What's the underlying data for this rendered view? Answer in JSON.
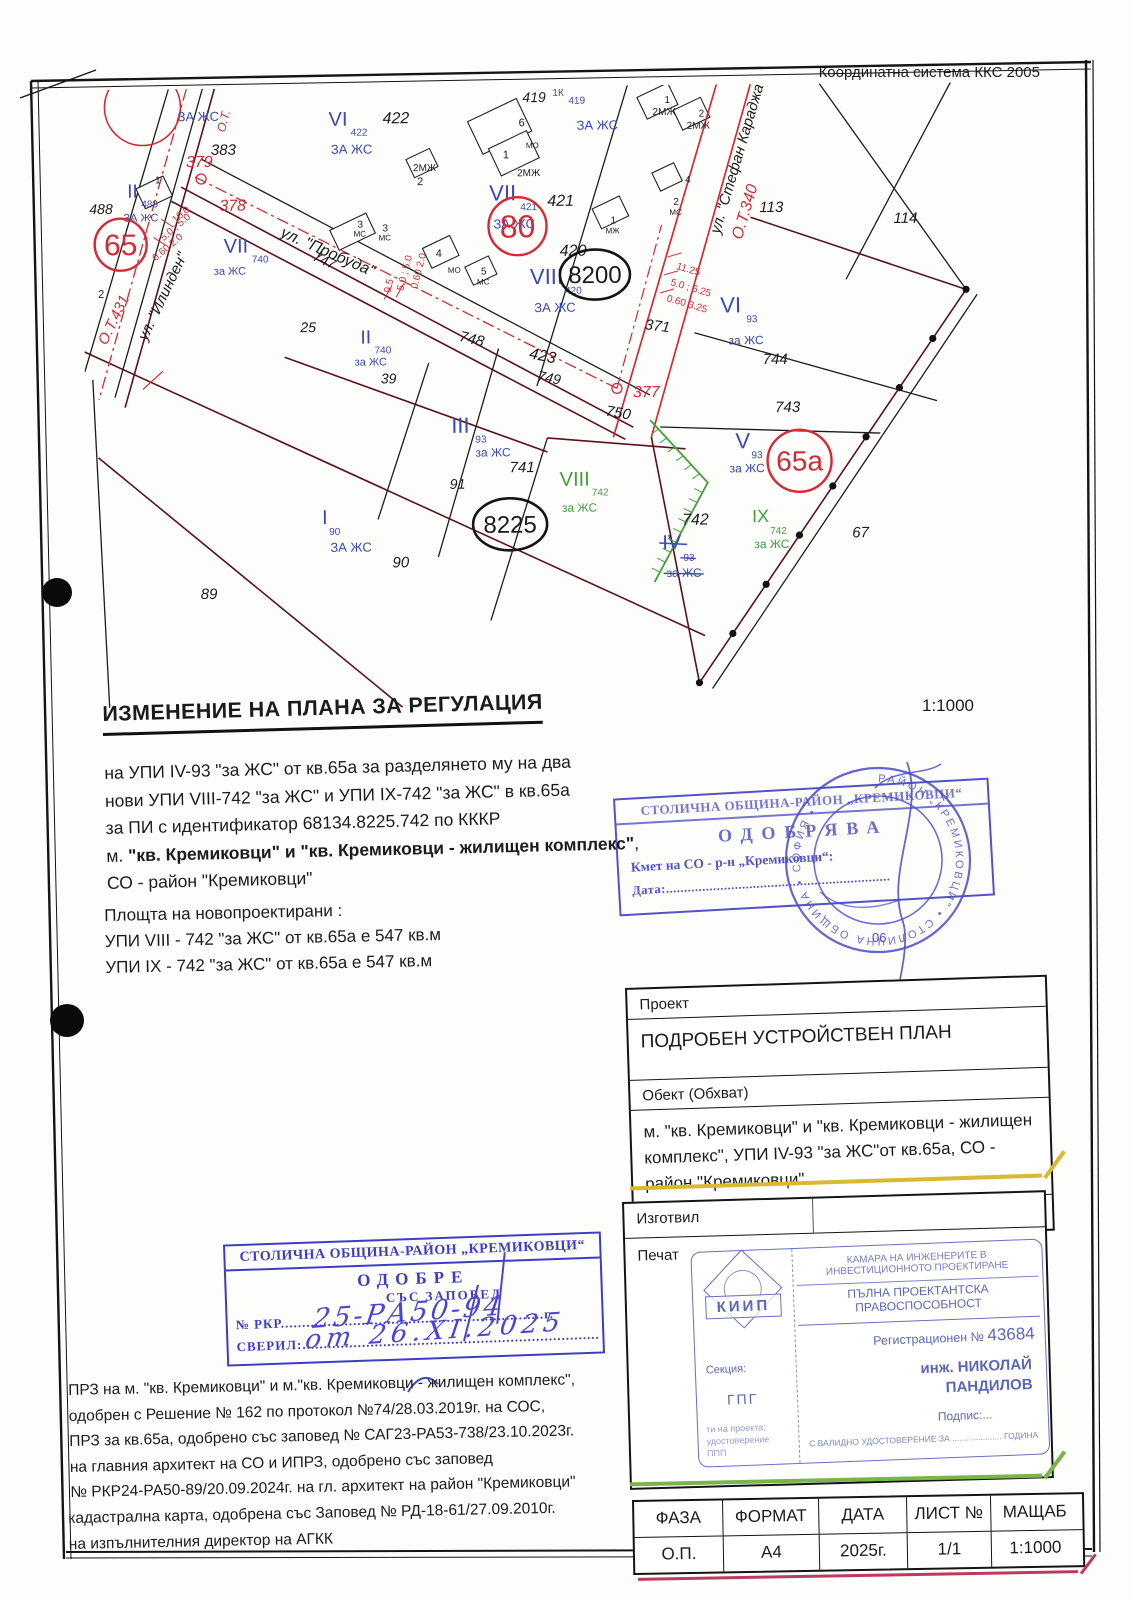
{
  "page": {
    "coord_system": "Координатна система ККС 2005",
    "map_scale": "1:1000",
    "title": "ИЗМЕНЕНИЕ НА ПЛАНА ЗА РЕГУЛАЦИЯ"
  },
  "description": {
    "line1": "на УПИ IV-93 \"за ЖС\" от кв.65а за разделянето му на два",
    "line2": "нови УПИ VIII-742 \"за ЖС\" и УПИ IX-742 \"за ЖС\" в кв.65а",
    "line3": "за ПИ с идентификатор 68134.8225.742 по КККР",
    "line4_prefix": "м. ",
    "line4_bold": "\"кв. Кремиковци\" и \"кв. Кремиковци - жилищен комплекс\"",
    "line4_suffix": ",",
    "line5": "СО - район \"Кремиковци\""
  },
  "areas": {
    "title": "Площта на новопроектирани :",
    "line1": "УПИ VIII - 742 \"за ЖС\" от кв.65а е 547 кв.м",
    "line2": "УПИ IX - 742 \"за ЖС\" от кв.65а е 547 кв.м"
  },
  "stamp_right": {
    "header": "СТОЛИЧНА ОБЩИНА-РАЙОН „КРЕМИКОВЦИ“",
    "action": "ОДОБРЯВА",
    "signer": "Кмет на СО - р-н „Кремиковци“:",
    "date_label": "Дата:..............................................................",
    "seal_ring_text": "РАЙОН „КРЕМИКОВЦИ\" • СТОЛИЧНА ОБЩИНА • СОФИЯ •",
    "seal_number": "06"
  },
  "project_table": {
    "project_label": "Проект",
    "project_value": "ПОДРОБЕН УСТРОЙСТВЕН ПЛАН",
    "object_label": "Обект (Обхват)",
    "object_value": "м. \"кв. Кремиковци\" и \"кв. Кремиковци - жилищен комплекс\", УПИ IV-93 \"за ЖС\"от кв.65а, СО - район \"Кремиковци\"",
    "part_label": "Част",
    "part_value": "ИПР"
  },
  "author_box": {
    "author_label": "Изготвил",
    "stamp_label": "Печат"
  },
  "kiip_stamp": {
    "org": "КАМАРА НА ИНЖЕНЕРИТЕ В ИНВЕСТИЦИОННОТО ПРОЕКТИРАНЕ",
    "qualification": "ПЪЛНА ПРОЕКТАНТСКА ПРАВОСПОСОБНОСТ",
    "reg_label": "Регистрационен № ",
    "reg_number": "43684",
    "name_line1": "инж. НИКОЛАЙ",
    "name_line2": "ПАНДИЛОВ",
    "logo": "КИИП",
    "section_label": "Секция:",
    "section_value": "ГПГ",
    "note1": "ти на проекта:",
    "note2": "удостоверение",
    "note3": "ППП",
    "signature_label": "Подпис:...",
    "footer": "С ВАЛИДНО УДОСТОВЕРЕНИЕ ЗА ..................... ГОДИНА"
  },
  "stamp_left": {
    "header": "СТОЛИЧНА ОБЩИНА-РАЙОН „КРЕМИКОВЦИ“",
    "action_line1": "ОДОБРЕ",
    "action_line2": "СЪС ЗАПОВЕД",
    "number_label": "№ РКР",
    "number_dots": "..............................................................г.",
    "number_value": "25-РА50-94",
    "checked_label": "СВЕРИЛ:",
    "checked_dots": "......................................................................",
    "checked_value": "от 26.ХІ.2025"
  },
  "notes": {
    "p1l1": "ПРЗ на м. \"кв. Кремиковци\" и м.\"кв. Кремиковци - жилищен комплекс\",",
    "p1l2": "одобрен с Решение № 162 по протокол №74/28.03.2019г. на СОС,",
    "p1l3": "ПРЗ за кв.65а, одобрено със заповед № САГ23-РА53-738/23.10.2023г.",
    "p1l4": "на главния архитект на СО и ИПРЗ, одобрено със заповед",
    "p1l5": "№ РКР24-РА50-89/20.09.2024г. на гл. архитект на район \"Кремиковци\"",
    "p2l1": "кадастрална карта, одобрена със Заповед № РД-18-61/27.09.2010г.",
    "p2l2": "на изпълнителния директор на АГКК"
  },
  "spec_table": {
    "headers": [
      "ФАЗА",
      "ФОРМАТ",
      "ДАТА",
      "ЛИСТ №",
      "МАЩАБ"
    ],
    "values": [
      "О.П.",
      "А4",
      "2025г.",
      "1/1",
      "1:1000"
    ]
  },
  "map": {
    "labels": [
      {
        "t": "ЗА ЖС",
        "x": 95,
        "y": 32,
        "c": "b",
        "s": 13
      },
      {
        "t": "О.Т.",
        "x": 142,
        "y": 44,
        "c": "r",
        "s": 12,
        "r": -75,
        "i": 1
      },
      {
        "t": "383",
        "x": 128,
        "y": 66,
        "c": "k",
        "s": 15,
        "i": 1
      },
      {
        "t": "379",
        "x": 103,
        "y": 78,
        "c": "r",
        "s": 16,
        "i": 1
      },
      {
        "t": "378",
        "x": 136,
        "y": 122,
        "c": "r",
        "s": 16,
        "i": 1
      },
      {
        "t": "II",
        "x": 44,
        "y": 108,
        "c": "b",
        "s": 19
      },
      {
        "t": "488",
        "x": 58,
        "y": 118,
        "c": "b",
        "s": 10
      },
      {
        "t": "1",
        "x": 72,
        "y": 94,
        "c": "k",
        "s": 10
      },
      {
        "t": "488",
        "x": 6,
        "y": 124,
        "c": "k",
        "s": 14,
        "i": 1
      },
      {
        "t": "ЗА ЖС",
        "x": 40,
        "y": 132,
        "c": "b",
        "s": 11
      },
      {
        "t": "2",
        "x": 14,
        "y": 208,
        "c": "k",
        "s": 11
      },
      {
        "t": "VII",
        "x": 140,
        "y": 164,
        "c": "b",
        "s": 20
      },
      {
        "t": "740",
        "x": 168,
        "y": 174,
        "c": "b",
        "s": 10
      },
      {
        "t": "за ЖС",
        "x": 130,
        "y": 186,
        "c": "b",
        "s": 11
      },
      {
        "t": "ул. \"Пробуда\"",
        "x": 196,
        "y": 148,
        "c": "k",
        "s": 16,
        "i": 1,
        "r": 24
      },
      {
        "t": "747",
        "x": 228,
        "y": 172,
        "c": "k",
        "s": 14,
        "i": 1,
        "r": 24
      },
      {
        "t": "ул. \"Илинден\"",
        "x": 62,
        "y": 252,
        "c": "k",
        "s": 15,
        "i": 1,
        "r": -64
      },
      {
        "t": "О.Т.431",
        "x": 22,
        "y": 256,
        "c": "r",
        "s": 15,
        "i": 1,
        "r": -64
      },
      {
        "t": "10.0",
        "x": 92,
        "y": 134,
        "c": "r",
        "s": 10,
        "r": -40
      },
      {
        "t": "5.0 ; 5.0",
        "x": 80,
        "y": 152,
        "c": "r",
        "s": 10,
        "r": -40
      },
      {
        "t": "0.60  2.0",
        "x": 72,
        "y": 172,
        "c": "r",
        "s": 10,
        "r": -40
      },
      {
        "t": "25",
        "x": 216,
        "y": 244,
        "c": "k",
        "s": 14,
        "i": 1
      },
      {
        "t": "II",
        "x": 276,
        "y": 256,
        "c": "b",
        "s": 19
      },
      {
        "t": "740",
        "x": 290,
        "y": 266,
        "c": "b",
        "s": 10
      },
      {
        "t": "за ЖС",
        "x": 270,
        "y": 278,
        "c": "b",
        "s": 11
      },
      {
        "t": "39",
        "x": 296,
        "y": 296,
        "c": "k",
        "s": 14,
        "i": 1
      },
      {
        "t": "9.5",
        "x": 306,
        "y": 206,
        "c": "r",
        "s": 10,
        "r": -75
      },
      {
        "t": "5.0 ; 5.0",
        "x": 319,
        "y": 204,
        "c": "r",
        "s": 10,
        "r": -75
      },
      {
        "t": "0.60  2.0",
        "x": 333,
        "y": 202,
        "c": "r",
        "s": 10,
        "r": -75
      },
      {
        "t": "VI",
        "x": 246,
        "y": 38,
        "c": "b",
        "s": 20
      },
      {
        "t": "422",
        "x": 268,
        "y": 48,
        "c": "b",
        "s": 10
      },
      {
        "t": "422",
        "x": 300,
        "y": 36,
        "c": "k",
        "s": 16,
        "i": 1
      },
      {
        "t": "ЗА ЖС",
        "x": 248,
        "y": 66,
        "c": "b",
        "s": 13
      },
      {
        "t": "2МЖ",
        "x": 330,
        "y": 84,
        "c": "k",
        "s": 10
      },
      {
        "t": "2",
        "x": 334,
        "y": 98,
        "c": "k",
        "s": 11
      },
      {
        "t": "3",
        "x": 274,
        "y": 140,
        "c": "k",
        "s": 10
      },
      {
        "t": "МС",
        "x": 270,
        "y": 149,
        "c": "k",
        "s": 8
      },
      {
        "t": "3",
        "x": 299,
        "y": 144,
        "c": "k",
        "s": 10
      },
      {
        "t": "МС",
        "x": 295,
        "y": 153,
        "c": "k",
        "s": 8
      },
      {
        "t": "4",
        "x": 352,
        "y": 170,
        "c": "k",
        "s": 11
      },
      {
        "t": "МО",
        "x": 364,
        "y": 186,
        "c": "k",
        "s": 8
      },
      {
        "t": "5",
        "x": 397,
        "y": 188,
        "c": "k",
        "s": 10
      },
      {
        "t": "МС",
        "x": 393,
        "y": 198,
        "c": "k",
        "s": 8
      },
      {
        "t": "VII",
        "x": 406,
        "y": 114,
        "c": "b",
        "s": 22
      },
      {
        "t": "421",
        "x": 437,
        "y": 124,
        "c": "b",
        "s": 10
      },
      {
        "t": "421",
        "x": 464,
        "y": 120,
        "c": "k",
        "s": 16,
        "i": 1
      },
      {
        "t": "ЗА ЖС",
        "x": 410,
        "y": 142,
        "c": "b",
        "s": 13
      },
      {
        "t": "419",
        "x": 440,
        "y": 16,
        "c": "k",
        "s": 14,
        "i": 1
      },
      {
        "t": "1К",
        "x": 470,
        "y": 10,
        "c": "b",
        "s": 10
      },
      {
        "t": "419",
        "x": 486,
        "y": 18,
        "c": "b",
        "s": 10
      },
      {
        "t": "ЗА ЖС",
        "x": 494,
        "y": 44,
        "c": "b",
        "s": 13
      },
      {
        "t": "6",
        "x": 436,
        "y": 40,
        "c": "k",
        "s": 11
      },
      {
        "t": "МО",
        "x": 443,
        "y": 62,
        "c": "k",
        "s": 8
      },
      {
        "t": "1",
        "x": 420,
        "y": 72,
        "c": "k",
        "s": 11
      },
      {
        "t": "2МЖ",
        "x": 434,
        "y": 90,
        "c": "k",
        "s": 10
      },
      {
        "t": "1",
        "x": 527,
        "y": 138,
        "c": "k",
        "s": 10
      },
      {
        "t": "МЖ",
        "x": 522,
        "y": 148,
        "c": "k",
        "s": 8
      },
      {
        "t": "1",
        "x": 582,
        "y": 18,
        "c": "k",
        "s": 10
      },
      {
        "t": "2МЖ",
        "x": 570,
        "y": 30,
        "c": "k",
        "s": 10
      },
      {
        "t": "2",
        "x": 616,
        "y": 32,
        "c": "k",
        "s": 10
      },
      {
        "t": "2МЖ",
        "x": 604,
        "y": 44,
        "c": "k",
        "s": 10
      },
      {
        "t": "4",
        "x": 602,
        "y": 98,
        "c": "k",
        "s": 10
      },
      {
        "t": "2",
        "x": 590,
        "y": 120,
        "c": "k",
        "s": 10
      },
      {
        "t": "МС",
        "x": 586,
        "y": 130,
        "c": "k",
        "s": 8
      },
      {
        "t": "ул. \"Стефан Караджа\"",
        "x": 636,
        "y": 150,
        "c": "k",
        "s": 15,
        "i": 1,
        "r": -73
      },
      {
        "t": "О.Т.340",
        "x": 658,
        "y": 156,
        "c": "r",
        "s": 16,
        "i": 1,
        "r": -73
      },
      {
        "t": "113",
        "x": 676,
        "y": 128,
        "c": "k",
        "s": 15,
        "i": 1
      },
      {
        "t": "114",
        "x": 810,
        "y": 140,
        "c": "k",
        "s": 15,
        "i": 1
      },
      {
        "t": "420",
        "x": 476,
        "y": 170,
        "c": "k",
        "s": 16,
        "i": 1
      },
      {
        "t": "VIII",
        "x": 446,
        "y": 198,
        "c": "b",
        "s": 22
      },
      {
        "t": "420",
        "x": 481,
        "y": 208,
        "c": "b",
        "s": 10
      },
      {
        "t": "ЗА ЖС",
        "x": 450,
        "y": 226,
        "c": "b",
        "s": 13
      },
      {
        "t": "371",
        "x": 560,
        "y": 244,
        "c": "k",
        "s": 15,
        "i": 1,
        "r": 8
      },
      {
        "t": "748",
        "x": 374,
        "y": 254,
        "c": "k",
        "s": 15,
        "i": 1,
        "r": 14
      },
      {
        "t": "423",
        "x": 444,
        "y": 272,
        "c": "k",
        "s": 16,
        "i": 1,
        "r": 12
      },
      {
        "t": "749",
        "x": 452,
        "y": 294,
        "c": "k",
        "s": 14,
        "i": 1,
        "r": 12
      },
      {
        "t": "750",
        "x": 520,
        "y": 330,
        "c": "k",
        "s": 15,
        "i": 1,
        "r": 10
      },
      {
        "t": "377",
        "x": 548,
        "y": 312,
        "c": "r",
        "s": 16,
        "i": 1
      },
      {
        "t": "11.25",
        "x": 592,
        "y": 184,
        "c": "r",
        "s": 10,
        "r": 17
      },
      {
        "t": "5.0 ; 6.25",
        "x": 586,
        "y": 200,
        "c": "r",
        "s": 10,
        "r": 17
      },
      {
        "t": "0.60  3.25",
        "x": 582,
        "y": 216,
        "c": "r",
        "s": 10,
        "r": 17
      },
      {
        "t": "VI",
        "x": 636,
        "y": 228,
        "c": "b",
        "s": 22
      },
      {
        "t": "93",
        "x": 662,
        "y": 238,
        "c": "b",
        "s": 10
      },
      {
        "t": "за ЖС",
        "x": 644,
        "y": 260,
        "c": "b",
        "s": 12
      },
      {
        "t": "744",
        "x": 678,
        "y": 280,
        "c": "k",
        "s": 15,
        "i": 1
      },
      {
        "t": "743",
        "x": 690,
        "y": 328,
        "c": "k",
        "s": 15,
        "i": 1
      },
      {
        "t": "V",
        "x": 650,
        "y": 364,
        "c": "b",
        "s": 22
      },
      {
        "t": "93",
        "x": 666,
        "y": 374,
        "c": "b",
        "s": 10
      },
      {
        "t": "за ЖС",
        "x": 644,
        "y": 388,
        "c": "b",
        "s": 12
      },
      {
        "t": "III",
        "x": 366,
        "y": 346,
        "c": "b",
        "s": 22
      },
      {
        "t": "93",
        "x": 390,
        "y": 356,
        "c": "b",
        "s": 10
      },
      {
        "t": "за ЖС",
        "x": 390,
        "y": 370,
        "c": "b",
        "s": 12
      },
      {
        "t": "741",
        "x": 424,
        "y": 386,
        "c": "k",
        "s": 15,
        "i": 1
      },
      {
        "t": "91",
        "x": 364,
        "y": 402,
        "c": "k",
        "s": 14,
        "i": 1
      },
      {
        "t": "VIII",
        "x": 474,
        "y": 400,
        "c": "g",
        "s": 20
      },
      {
        "t": "742",
        "x": 506,
        "y": 410,
        "c": "g",
        "s": 10
      },
      {
        "t": "за ЖС",
        "x": 476,
        "y": 426,
        "c": "g",
        "s": 12
      },
      {
        "t": "742",
        "x": 596,
        "y": 440,
        "c": "k",
        "s": 16,
        "i": 1
      },
      {
        "t": "IV",
        "x": 576,
        "y": 464,
        "c": "b",
        "s": 20,
        "st": 1
      },
      {
        "t": "93",
        "x": 597,
        "y": 476,
        "c": "b",
        "s": 10,
        "st": 1
      },
      {
        "t": "за ЖС",
        "x": 580,
        "y": 492,
        "c": "b",
        "s": 12,
        "st": 1
      },
      {
        "t": "IX",
        "x": 666,
        "y": 438,
        "c": "g",
        "s": 18
      },
      {
        "t": "742",
        "x": 684,
        "y": 450,
        "c": "g",
        "s": 10
      },
      {
        "t": "за ЖС",
        "x": 668,
        "y": 464,
        "c": "g",
        "s": 12
      },
      {
        "t": "67",
        "x": 766,
        "y": 454,
        "c": "k",
        "s": 15,
        "i": 1
      },
      {
        "t": "I",
        "x": 236,
        "y": 436,
        "c": "b",
        "s": 20
      },
      {
        "t": "90",
        "x": 243,
        "y": 447,
        "c": "b",
        "s": 10
      },
      {
        "t": "ЗА ЖС",
        "x": 244,
        "y": 464,
        "c": "b",
        "s": 13
      },
      {
        "t": "90",
        "x": 306,
        "y": 480,
        "c": "k",
        "s": 15,
        "i": 1
      },
      {
        "t": "89",
        "x": 114,
        "y": 510,
        "c": "k",
        "s": 15,
        "i": 1
      }
    ],
    "rings": [
      {
        "t": "65",
        "x": 37,
        "y": 155,
        "rx": 26,
        "ry": 26,
        "c": "r",
        "ts": 30
      },
      {
        "t": "80",
        "x": 434,
        "y": 140,
        "rx": 29,
        "ry": 29,
        "c": "r",
        "ts": 32
      },
      {
        "t": "65а",
        "x": 714,
        "y": 377,
        "rx": 32,
        "ry": 31,
        "c": "r",
        "ts": 28
      },
      {
        "t": "8200",
        "x": 511,
        "y": 189,
        "rx": 35,
        "ry": 25,
        "c": "k",
        "ts": 24
      },
      {
        "t": "8225",
        "x": 424,
        "y": 438,
        "rx": 37,
        "ry": 26,
        "c": "k",
        "ts": 24
      }
    ]
  }
}
